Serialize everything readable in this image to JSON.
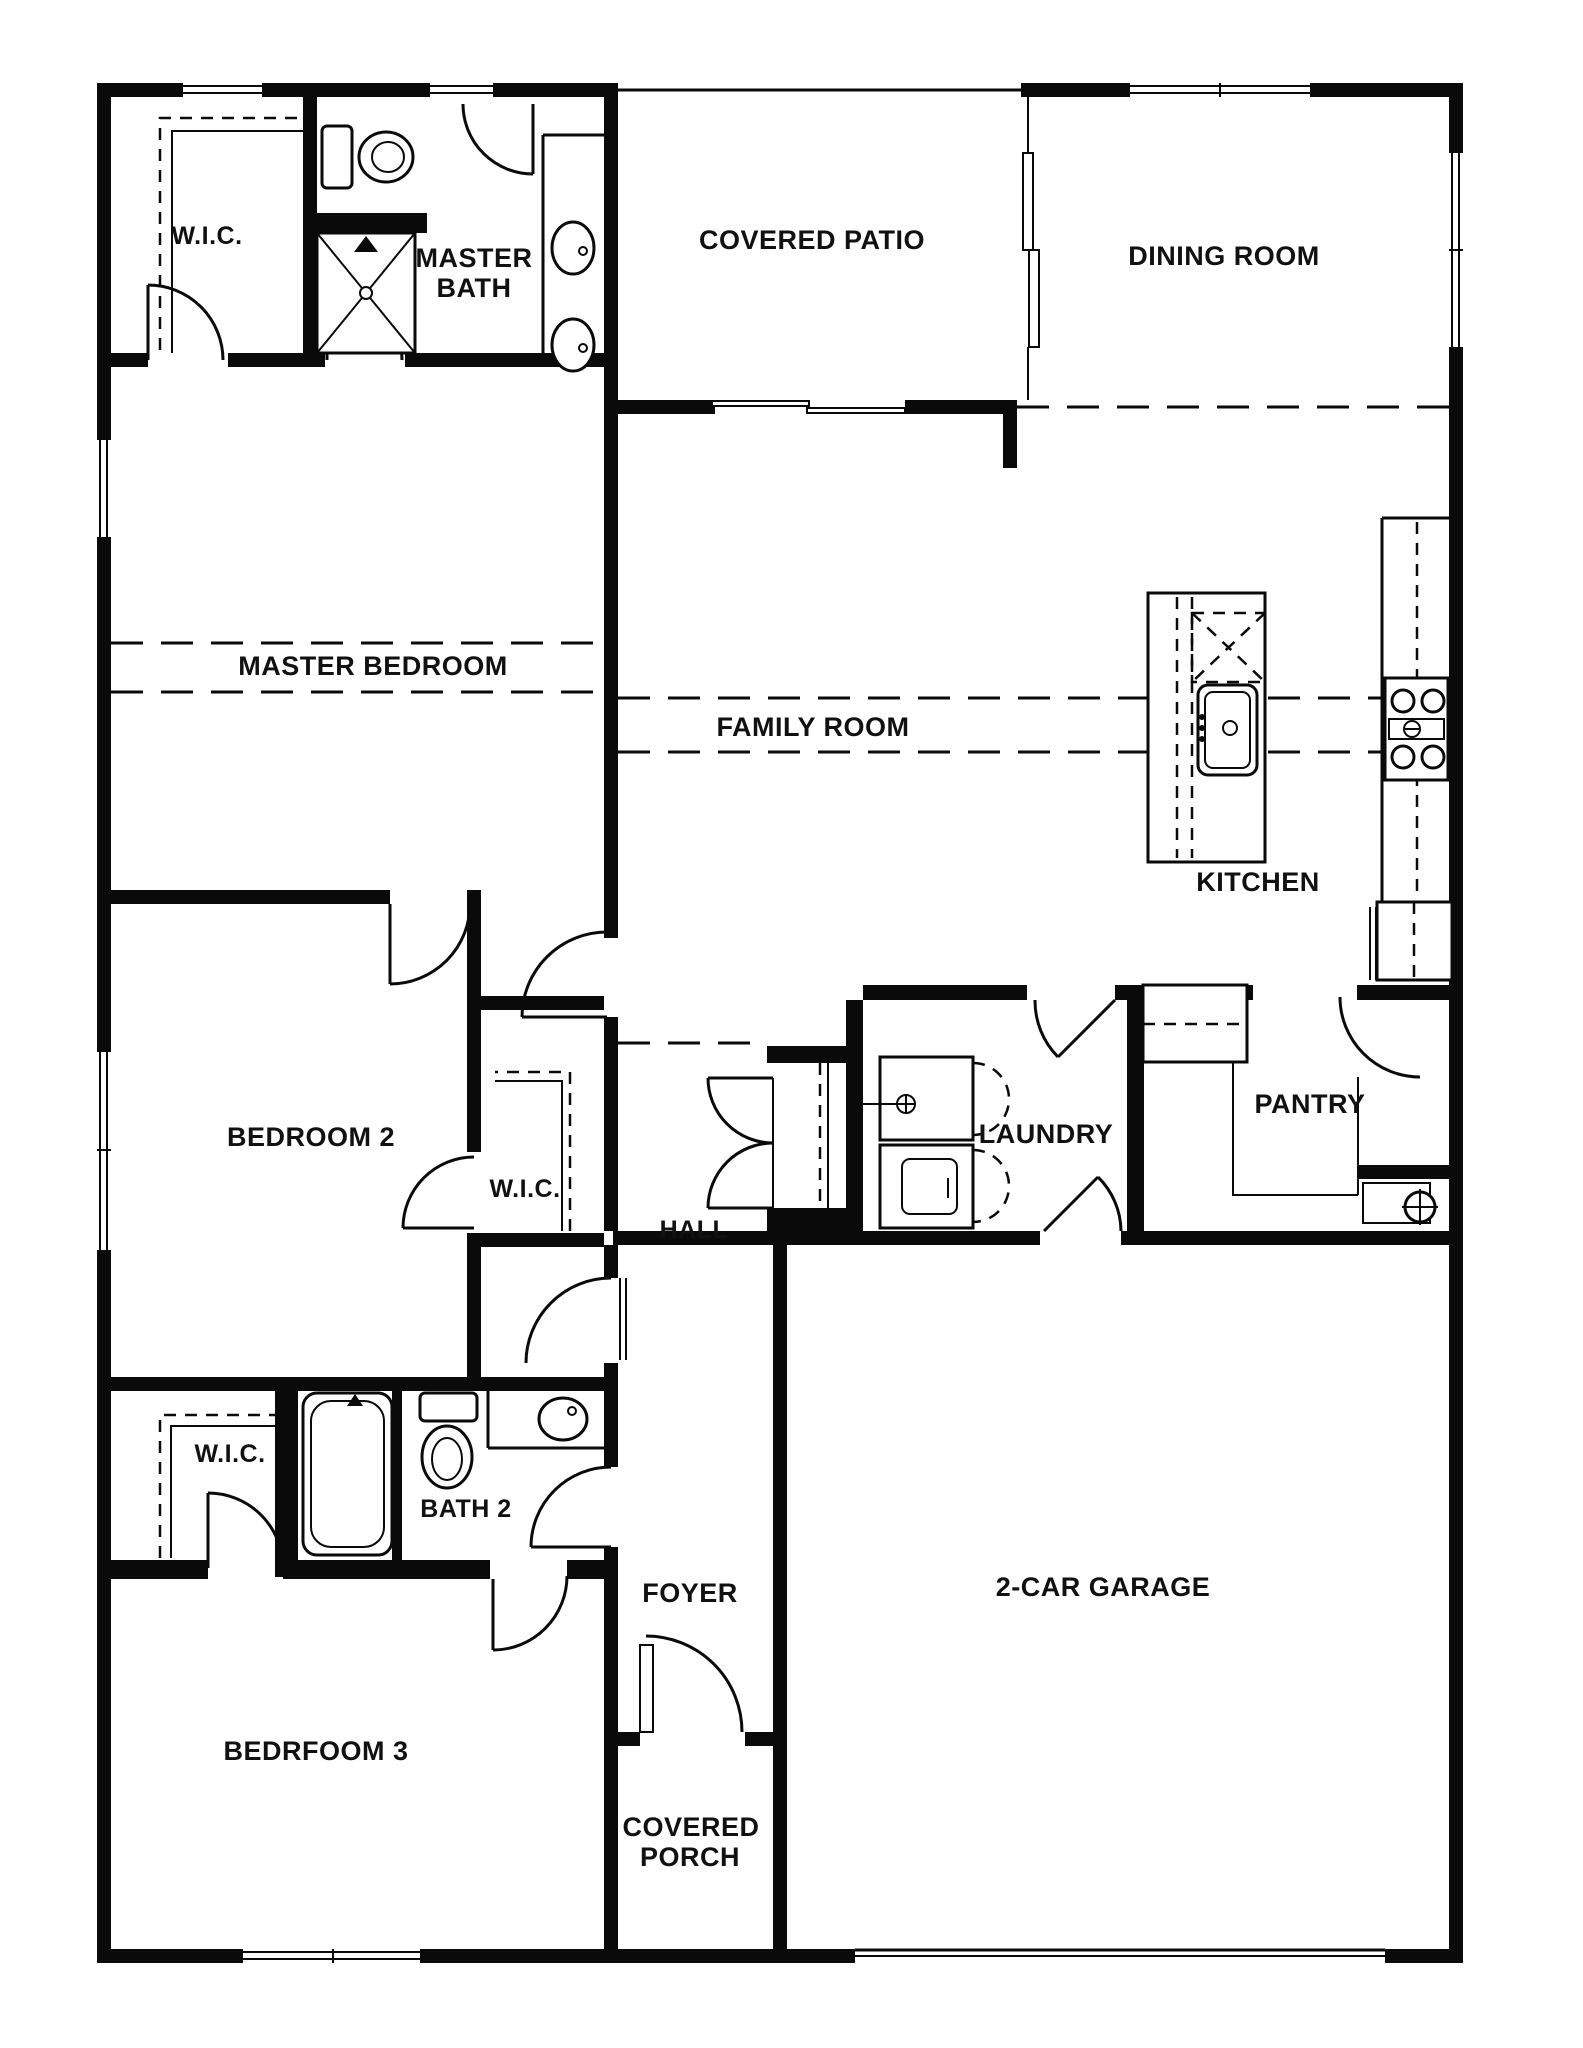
{
  "document": {
    "type": "floor-plan",
    "colors": {
      "wall": "#0a0a0a",
      "background": "#ffffff",
      "text": "#111111"
    }
  },
  "labels": {
    "wic_master": "W.I.C.",
    "master_bath_1": "MASTER",
    "master_bath_2": "BATH",
    "covered_patio": "COVERED PATIO",
    "dining_room": "DINING ROOM",
    "master_bedroom": "MASTER BEDROOM",
    "family_room": "FAMILY ROOM",
    "kitchen": "KITCHEN",
    "bedroom_2": "BEDROOM 2",
    "wic_bedroom2": "W.I.C.",
    "hall": "HALL",
    "laundry": "LAUNDRY",
    "pantry": "PANTRY",
    "wic_bedroom3": "W.I.C.",
    "bath_2": "BATH 2",
    "foyer": "FOYER",
    "garage": "2-CAR GARAGE",
    "bedroom_3": "BEDRFOOM 3",
    "covered_porch_1": "COVERED",
    "covered_porch_2": "PORCH"
  }
}
